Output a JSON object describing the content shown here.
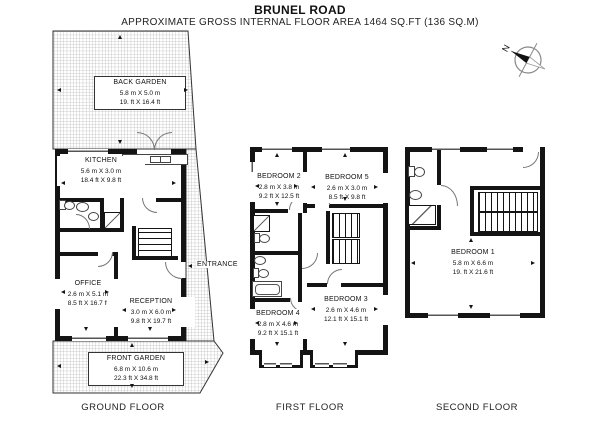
{
  "header": {
    "title": "BRUNEL ROAD",
    "subtitle": "APPROXIMATE GROSS INTERNAL FLOOR AREA 1464 SQ.FT (136 SQ.M)"
  },
  "compass": {
    "north_label": "N"
  },
  "palette": {
    "wall": "#141414",
    "hatch_line": "#9b9b9b",
    "outline": "#333333",
    "background": "#ffffff"
  },
  "floors": {
    "ground": {
      "label": "GROUND FLOOR",
      "entrance_label": "ENTRANCE",
      "rooms": {
        "back_garden": {
          "name": "BACK GARDEN",
          "metric": "5.8 m X 5.0 m",
          "imperial": "19. ft X 16.4 ft"
        },
        "kitchen": {
          "name": "KITCHEN",
          "metric": "5.6 m X 3.0 m",
          "imperial": "18.4 ft X 9.8 ft"
        },
        "office": {
          "name": "OFFICE",
          "metric": "2.6 m X 5.1 m",
          "imperial": "8.5 ft X 16.7 ft"
        },
        "reception": {
          "name": "RECEPTION",
          "metric": "3.0 m X 6.0 m",
          "imperial": "9.8 ft X 19.7 ft"
        },
        "front_garden": {
          "name": "FRONT GARDEN",
          "metric": "6.8 m X 10.6 m",
          "imperial": "22.3 ft X 34.8 ft"
        }
      }
    },
    "first": {
      "label": "FIRST FLOOR",
      "rooms": {
        "bedroom_2": {
          "name": "BEDROOM 2",
          "metric": "2.8 m X 3.8 m",
          "imperial": "9.2 ft X 12.5 ft"
        },
        "bedroom_5": {
          "name": "BEDROOM 5",
          "metric": "2.6 m X 3.0 m",
          "imperial": "8.5 ft X 9.8 ft"
        },
        "bedroom_4": {
          "name": "BEDROOM 4",
          "metric": "2.8 m X 4.6 m",
          "imperial": "9.2 ft X 15.1 ft"
        },
        "bedroom_3": {
          "name": "BEDROOM 3",
          "metric": "2.6 m X 4.6 m",
          "imperial": "12.1 ft X 15.1 ft"
        }
      }
    },
    "second": {
      "label": "SECOND FLOOR",
      "rooms": {
        "bedroom_1": {
          "name": "BEDROOM 1",
          "metric": "5.8 m X 6.6 m",
          "imperial": "19. ft X 21.6 ft"
        }
      }
    }
  }
}
